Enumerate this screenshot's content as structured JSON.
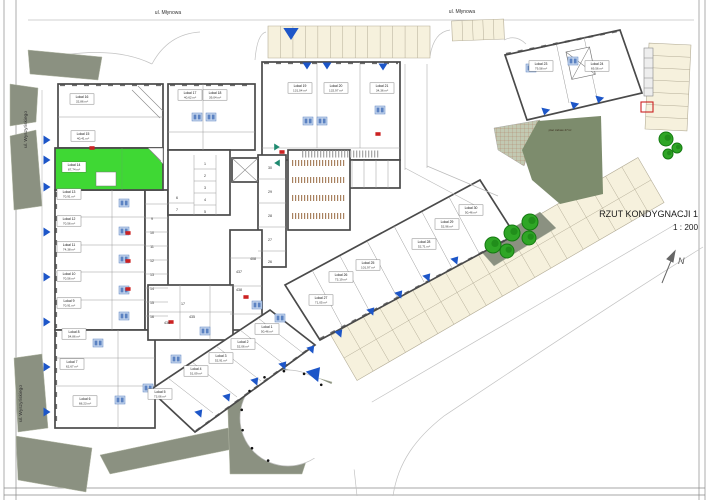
{
  "title": {
    "name": "RZUT KONDYGNACJI 1",
    "scale": "1 : 200"
  },
  "streets": {
    "top_left": "ul. Młynowa",
    "top_right": "ul. Młynowa",
    "left_upper": "ul. Wyszyńskiego",
    "left_lower": "ul. Wyszyńskiego"
  },
  "north": {
    "label": "N"
  },
  "playground": {
    "label": "plac zabaw 47m²"
  },
  "highlighted_unit": {
    "label": "Lokal 14",
    "area": "87,74 m²"
  },
  "units": [
    {
      "label": "Lokal 1",
      "area": "50,46 m²",
      "x": 267,
      "y": 329
    },
    {
      "label": "Lokal 2",
      "area": "52,06 m²",
      "x": 243,
      "y": 344
    },
    {
      "label": "Lokal 3",
      "area": "52,91 m²",
      "x": 221,
      "y": 358
    },
    {
      "label": "Lokal 4",
      "area": "51,09 m²",
      "x": 196,
      "y": 371
    },
    {
      "label": "Lokal 5",
      "area": "73,06 m²",
      "x": 160,
      "y": 394
    },
    {
      "label": "Lokal 6",
      "area": "68,23 m²",
      "x": 85,
      "y": 401
    },
    {
      "label": "Lokal 7",
      "area": "62,67 m²",
      "x": 72,
      "y": 364
    },
    {
      "label": "Lokal 8",
      "area": "54,86 m²",
      "x": 74,
      "y": 334
    },
    {
      "label": "Lokal 9",
      "area": "70,91 m²",
      "x": 69,
      "y": 303
    },
    {
      "label": "Lokal 10",
      "area": "70,56 m²",
      "x": 69,
      "y": 276
    },
    {
      "label": "Lokal 11",
      "area": "74,38 m²",
      "x": 69,
      "y": 247
    },
    {
      "label": "Lokal 12",
      "area": "70,56 m²",
      "x": 69,
      "y": 221
    },
    {
      "label": "Lokal 13",
      "area": "70,91 m²",
      "x": 69,
      "y": 194
    },
    {
      "label": "Lokal 14",
      "area": "87,74 m²",
      "x": 74,
      "y": 167,
      "highlight": true
    },
    {
      "label": "Lokal 15",
      "area": "40,41 m²",
      "x": 83,
      "y": 136
    },
    {
      "label": "Lokal 16",
      "area": "32,86 m²",
      "x": 82,
      "y": 99
    },
    {
      "label": "Lokal 17",
      "area": "40,62 m²",
      "x": 190,
      "y": 95
    },
    {
      "label": "Lokal 18",
      "area": "39,04 m²",
      "x": 215,
      "y": 95
    },
    {
      "label": "Lokal 19",
      "area": "131,04 m²",
      "x": 300,
      "y": 88
    },
    {
      "label": "Lokal 20",
      "area": "132,97 m²",
      "x": 336,
      "y": 88
    },
    {
      "label": "Lokal 21",
      "area": "34,36 m²",
      "x": 382,
      "y": 88
    },
    {
      "label": "Lokal 23",
      "area": "79,58 m²",
      "x": 541,
      "y": 66
    },
    {
      "label": "Lokal 24",
      "area": "69,56 m²",
      "x": 597,
      "y": 66
    },
    {
      "label": "Lokal 25",
      "area": "101,97 m²",
      "x": 368,
      "y": 265
    },
    {
      "label": "Lokal 26",
      "area": "73,19 m²",
      "x": 341,
      "y": 277
    },
    {
      "label": "Lokal 27",
      "area": "71,05 m²",
      "x": 321,
      "y": 300
    },
    {
      "label": "Lokal 28",
      "area": "52,71 m²",
      "x": 424,
      "y": 244
    },
    {
      "label": "Lokal 29",
      "area": "52,96 m²",
      "x": 447,
      "y": 224
    },
    {
      "label": "Lokal 30",
      "area": "50,46 m²",
      "x": 471,
      "y": 210
    }
  ],
  "storage_cells": [
    {
      "n": "9",
      "x": 152,
      "y": 220
    },
    {
      "n": "10",
      "x": 152,
      "y": 234
    },
    {
      "n": "11",
      "x": 152,
      "y": 248
    },
    {
      "n": "12",
      "x": 152,
      "y": 262
    },
    {
      "n": "13",
      "x": 152,
      "y": 276
    },
    {
      "n": "14",
      "x": 152,
      "y": 290
    },
    {
      "n": "15",
      "x": 152,
      "y": 304
    },
    {
      "n": "16",
      "x": 152,
      "y": 318
    },
    {
      "n": "30",
      "x": 270,
      "y": 169
    },
    {
      "n": "29",
      "x": 270,
      "y": 193
    },
    {
      "n": "28",
      "x": 270,
      "y": 217
    },
    {
      "n": "27",
      "x": 270,
      "y": 241
    },
    {
      "n": "26",
      "x": 270,
      "y": 263
    },
    {
      "n": "1",
      "x": 205,
      "y": 165
    },
    {
      "n": "2",
      "x": 205,
      "y": 177
    },
    {
      "n": "3",
      "x": 205,
      "y": 189
    },
    {
      "n": "4",
      "x": 205,
      "y": 201
    },
    {
      "n": "5",
      "x": 205,
      "y": 213
    },
    {
      "n": "6",
      "x": 177,
      "y": 199
    },
    {
      "n": "7",
      "x": 177,
      "y": 211
    },
    {
      "n": "17",
      "x": 183,
      "y": 305
    },
    {
      "n": "435",
      "x": 192,
      "y": 318
    },
    {
      "n": "436",
      "x": 167,
      "y": 324
    },
    {
      "n": "408",
      "x": 253,
      "y": 260
    },
    {
      "n": "437",
      "x": 239,
      "y": 273
    },
    {
      "n": "438",
      "x": 239,
      "y": 291
    }
  ],
  "markers": {
    "entrances": [
      [
        291,
        34,
        0,
        1.7
      ],
      [
        307,
        66,
        0
      ],
      [
        327,
        66,
        0
      ],
      [
        383,
        67,
        0
      ],
      [
        545,
        112,
        13
      ],
      [
        574,
        106,
        13
      ],
      [
        599,
        100,
        13
      ],
      [
        47,
        140,
        270
      ],
      [
        47,
        160,
        270
      ],
      [
        47,
        187,
        270
      ],
      [
        47,
        232,
        270
      ],
      [
        47,
        277,
        270
      ],
      [
        47,
        322,
        270
      ],
      [
        47,
        367,
        270
      ],
      [
        47,
        412,
        270
      ],
      [
        200,
        412,
        220
      ],
      [
        228,
        396,
        220
      ],
      [
        256,
        380,
        220
      ],
      [
        284,
        364,
        220
      ],
      [
        312,
        348,
        220
      ],
      [
        340,
        332,
        220
      ],
      [
        372,
        310,
        220
      ],
      [
        400,
        293,
        220
      ],
      [
        428,
        276,
        220
      ],
      [
        456,
        259,
        220
      ],
      [
        316,
        372,
        220,
        1.8
      ]
    ],
    "teal_arrows": [
      [
        277,
        147,
        270
      ],
      [
        277,
        163,
        90
      ]
    ],
    "doors": [
      [
        128,
        233
      ],
      [
        128,
        261
      ],
      [
        128,
        289
      ],
      [
        92,
        148
      ],
      [
        282,
        152
      ],
      [
        378,
        134
      ],
      [
        171,
        322
      ],
      [
        246,
        297
      ]
    ],
    "red_outline": [
      641,
      102,
      12,
      10
    ],
    "wc": [
      [
        124,
        203
      ],
      [
        124,
        231
      ],
      [
        124,
        259
      ],
      [
        124,
        290
      ],
      [
        124,
        316
      ],
      [
        98,
        343
      ],
      [
        120,
        400
      ],
      [
        148,
        388
      ],
      [
        197,
        117
      ],
      [
        211,
        117
      ],
      [
        308,
        121
      ],
      [
        322,
        121
      ],
      [
        380,
        110
      ],
      [
        531,
        68
      ],
      [
        573,
        61
      ],
      [
        205,
        331
      ],
      [
        176,
        359
      ],
      [
        257,
        305
      ],
      [
        280,
        318
      ]
    ]
  },
  "trees": [
    [
      530,
      222,
      8
    ],
    [
      512,
      233,
      8
    ],
    [
      529,
      238,
      7
    ],
    [
      493,
      245,
      8
    ],
    [
      507,
      251,
      7
    ],
    [
      666,
      139,
      7
    ],
    [
      677,
      148,
      5
    ],
    [
      668,
      154,
      5
    ]
  ],
  "bollards": {
    "cx": 288,
    "cy": 418,
    "r": 47,
    "angles": [
      45,
      70,
      95,
      120,
      145,
      170,
      195,
      220,
      245
    ]
  },
  "parking": {
    "strips": [
      {
        "a": [
          268,
          42
        ],
        "b": [
          430,
          42
        ],
        "w": 32,
        "n": 13
      },
      {
        "a": [
          452,
          31
        ],
        "b": [
          504,
          29
        ],
        "w": 20,
        "n": 5
      },
      {
        "a": [
          670,
          44
        ],
        "b": [
          666,
          130
        ],
        "w": 42,
        "n": 7
      },
      {
        "a": [
          651,
          180
        ],
        "b": [
          344,
          358
        ],
        "w": 52,
        "n": 19,
        "aisle": true
      }
    ]
  },
  "colors": {
    "olive": "#8b9181",
    "dark_green": "#7d8c6d",
    "hatch_green": "#c2c9b2",
    "highlight": "#3fd834",
    "parking": "#f6f1dd",
    "parking_line": "#b3ac96",
    "wall": "#4a4a4a",
    "blue": "#1d56c8",
    "teal": "#1f8a70",
    "red": "#cc2222",
    "wc_fill": "#c6d6ec",
    "wc_stroke": "#5b82c2",
    "tree": "#2fa626",
    "tree_dark": "#157a12"
  }
}
